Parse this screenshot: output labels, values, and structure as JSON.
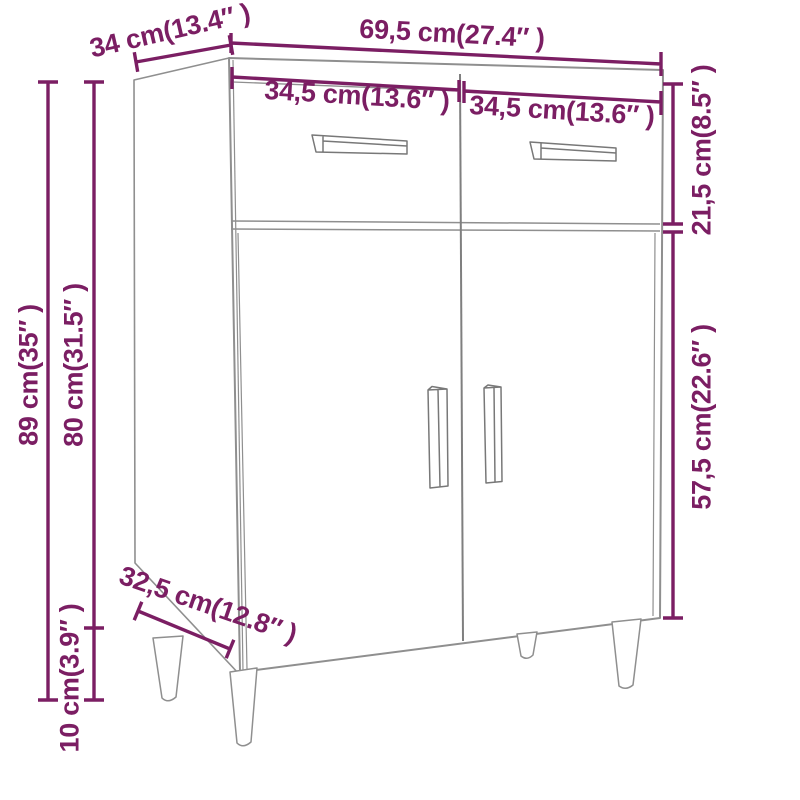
{
  "page": {
    "background": "#FFFFFF",
    "description": "Dimension diagram of a sideboard with two drawers, two doors and four tapered legs"
  },
  "style": {
    "accent_color": "#7B1E63",
    "linework_color": "#8F8F8F"
  },
  "dimensions": {
    "total_width": {
      "label": "69,5 cm(27.4″ )",
      "cm": "69,5",
      "inches": "27.4"
    },
    "top_depth": {
      "label": "34 cm(13.4″ )",
      "cm": "34",
      "inches": "13.4"
    },
    "left_drawer_width": {
      "label": "34,5 cm(13.6″ )",
      "cm": "34,5",
      "inches": "13.6"
    },
    "right_drawer_width": {
      "label": "34,5 cm(13.6″ )",
      "cm": "34,5",
      "inches": "13.6"
    },
    "drawer_section_height": {
      "label": "21,5 cm(8.5″ )",
      "cm": "21,5",
      "inches": "8.5"
    },
    "door_section_height": {
      "label": "57,5 cm(22.6″ )",
      "cm": "57,5",
      "inches": "22.6"
    },
    "total_height": {
      "label": "89 cm(35″ )",
      "cm": "89",
      "inches": "35"
    },
    "body_height": {
      "label": "80 cm(31.5″ )",
      "cm": "80",
      "inches": "31.5"
    },
    "leg_height": {
      "label": "10 cm(3.9″ )",
      "cm": "10",
      "inches": "3.9"
    },
    "bottom_depth": {
      "label": "32,5 cm(12.8″ )",
      "cm": "32,5",
      "inches": "12.8"
    }
  }
}
